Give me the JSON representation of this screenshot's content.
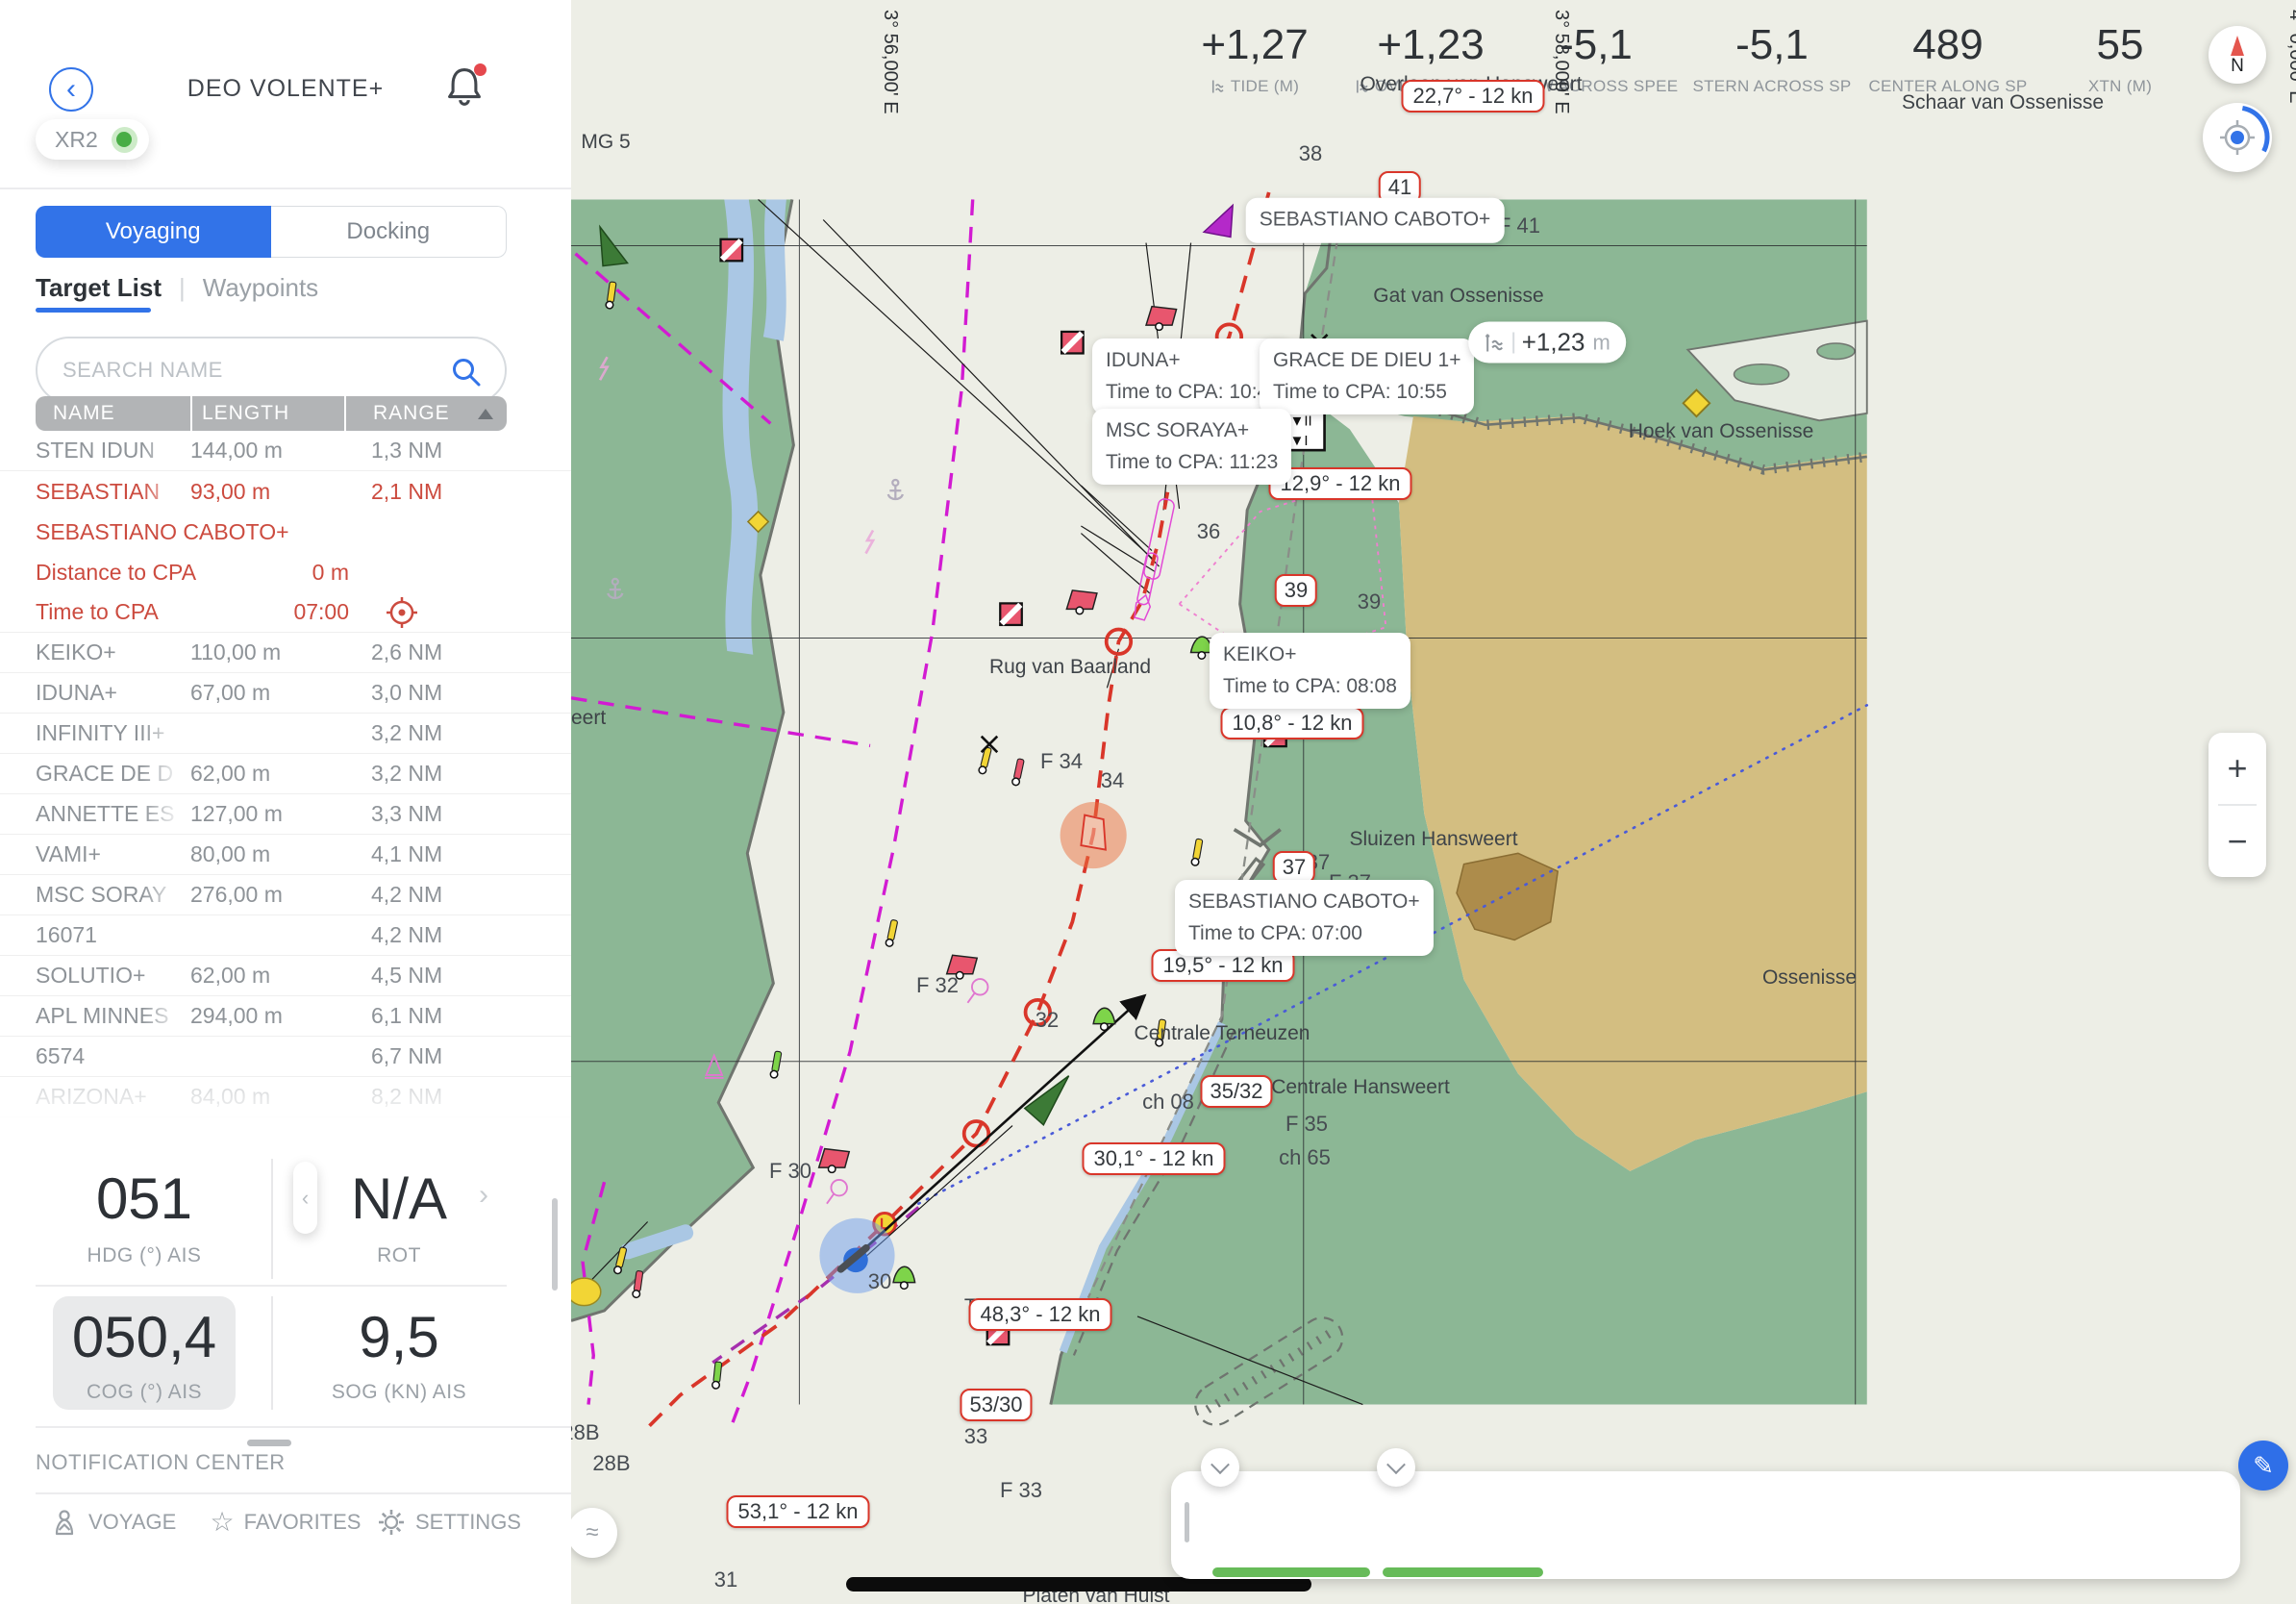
{
  "header": {
    "title": "DEO VOLENTE+",
    "device": "XR2"
  },
  "icons": {
    "back": "‹",
    "prev": "‹",
    "next": "›",
    "star": "☆",
    "pencil": "✎",
    "waves": "≈"
  },
  "tabs": {
    "voyaging": "Voyaging",
    "docking": "Docking"
  },
  "subtabs": {
    "target_list": "Target List",
    "sep": "|",
    "waypoints": "Waypoints"
  },
  "search": {
    "placeholder": "SEARCH NAME"
  },
  "table": {
    "columns": [
      "NAME",
      "LENGTH",
      "RANGE"
    ],
    "rows": [
      {
        "name": "STEN IDUN",
        "length": "144,00 m",
        "range": "1,3 NM"
      },
      {
        "name": "SEBASTIAN",
        "length": "93,00 m",
        "range": "2,1 NM"
      },
      {
        "name": "KEIKO+",
        "length": "110,00 m",
        "range": "2,6 NM"
      },
      {
        "name": "IDUNA+",
        "length": "67,00 m",
        "range": "3,0 NM"
      },
      {
        "name": "INFINITY III+",
        "length": "",
        "range": "3,2 NM"
      },
      {
        "name": "GRACE DE D",
        "length": "62,00 m",
        "range": "3,2 NM"
      },
      {
        "name": "ANNETTE ES",
        "length": "127,00 m",
        "range": "3,3 NM"
      },
      {
        "name": "VAMI+",
        "length": "80,00 m",
        "range": "4,1 NM"
      },
      {
        "name": "MSC SORAY",
        "length": "276,00 m",
        "range": "4,2 NM"
      },
      {
        "name": "16071",
        "length": "",
        "range": "4,2 NM"
      },
      {
        "name": "SOLUTIO+",
        "length": "62,00 m",
        "range": "4,5 NM"
      },
      {
        "name": "APL MINNES",
        "length": "294,00 m",
        "range": "6,1 NM"
      },
      {
        "name": "6574",
        "length": "",
        "range": "6,7 NM"
      },
      {
        "name": "ARIZONA+",
        "length": "84,00 m",
        "range": "8,2 NM"
      }
    ],
    "selected": {
      "full_name": "SEBASTIANO CABOTO+",
      "dist_label": "Distance to CPA",
      "dist": "0 m",
      "time_label": "Time to CPA",
      "time": "07:00"
    }
  },
  "stats": {
    "hdg": {
      "value": "051",
      "label": "HDG (°) AIS"
    },
    "rot": {
      "value": "N/A",
      "label": "ROT"
    },
    "cog": {
      "value": "050,4",
      "label": "COG (°) AIS"
    },
    "sog": {
      "value": "9,5",
      "label": "SOG (KN) AIS"
    }
  },
  "notification_center": {
    "title": "NOTIFICATION CENTER"
  },
  "nav": {
    "voyage": "VOYAGE",
    "favorites": "FAVORITES",
    "settings": "SETTINGS"
  },
  "map": {
    "grid": [
      "3° 56,000' E",
      "3° 58,000' E",
      "4° 0,000' E"
    ],
    "places": [
      "Schaar van Ossenisse",
      "Hoek van Ossenisse",
      "Gat van Ossenisse",
      "Overloop van Hansweert",
      "Rug van Baarland",
      "Sluizen Hansweert",
      "Ossenisse",
      "Centrale Terneuzen",
      "Centrale Hansweert",
      "Platen van Hulst",
      "MG 5",
      "eert",
      "Te"
    ],
    "depths": [
      "38",
      "36",
      "39",
      "34",
      "37",
      "32",
      "30",
      "33",
      "31"
    ],
    "marks": [
      "F 41",
      "F 37",
      "F 34",
      "F 32",
      "F 35",
      "F 33",
      "F 30",
      "ch 08",
      "ch 65",
      "28B",
      "28B"
    ],
    "speed_labels": [
      "22,7° - 12 kn",
      "12,9° - 12 kn",
      "10,8° - 12 kn",
      "19,5° - 12 kn",
      "30,1° - 12 kn",
      "48,3° - 12 kn",
      "53,1° - 12 kn"
    ],
    "occluded_label": {
      "left": "20",
      "right": "- 12 kn"
    },
    "num_labels": [
      "41",
      "39",
      "37",
      "35/32",
      "53/30"
    ],
    "callouts": [
      {
        "name": "SEBASTIANO CABOTO+",
        "time": ""
      },
      {
        "name": "IDUNA+",
        "time": "Time to CPA: 10:47"
      },
      {
        "name": "GRACE DE DIEU 1+",
        "time": "Time to CPA: 10:55"
      },
      {
        "name": "MSC SORAYA+",
        "time": "Time to CPA: 11:23"
      },
      {
        "name": "KEIKO+",
        "time": "Time to CPA: 08:08"
      },
      {
        "name": "SEBASTIANO CABOTO+",
        "time": "Time to CPA: 07:00"
      }
    ],
    "tide_pill": {
      "value": "+1,23",
      "unit": "m"
    },
    "topmark": [
      "▼II",
      "▼I"
    ],
    "controls": {
      "compass": "N",
      "zoom_in": "+",
      "zoom_out": "−"
    }
  },
  "info_bar": {
    "items": [
      {
        "value": "+1,27",
        "label": "TIDE (M)"
      },
      {
        "value": "+1,23",
        "label": "OVERLOOP VAN"
      },
      {
        "value": "-5,1",
        "label": "BOW ACROSS SPEE"
      },
      {
        "value": "-5,1",
        "label": "STERN ACROSS SP"
      },
      {
        "value": "489",
        "label": "CENTER ALONG SP"
      },
      {
        "value": "55",
        "label": "XTN (M)"
      }
    ]
  },
  "colors": {
    "accent": "#3273e8",
    "alert": "#cc4b3f",
    "route": "#d9362a",
    "magenta": "#d21bd2",
    "land": "#8cb795",
    "sand": "#d3be81",
    "water": "#aac7e4",
    "ownship": "#2f6fd8",
    "target": "#a02ec6"
  }
}
